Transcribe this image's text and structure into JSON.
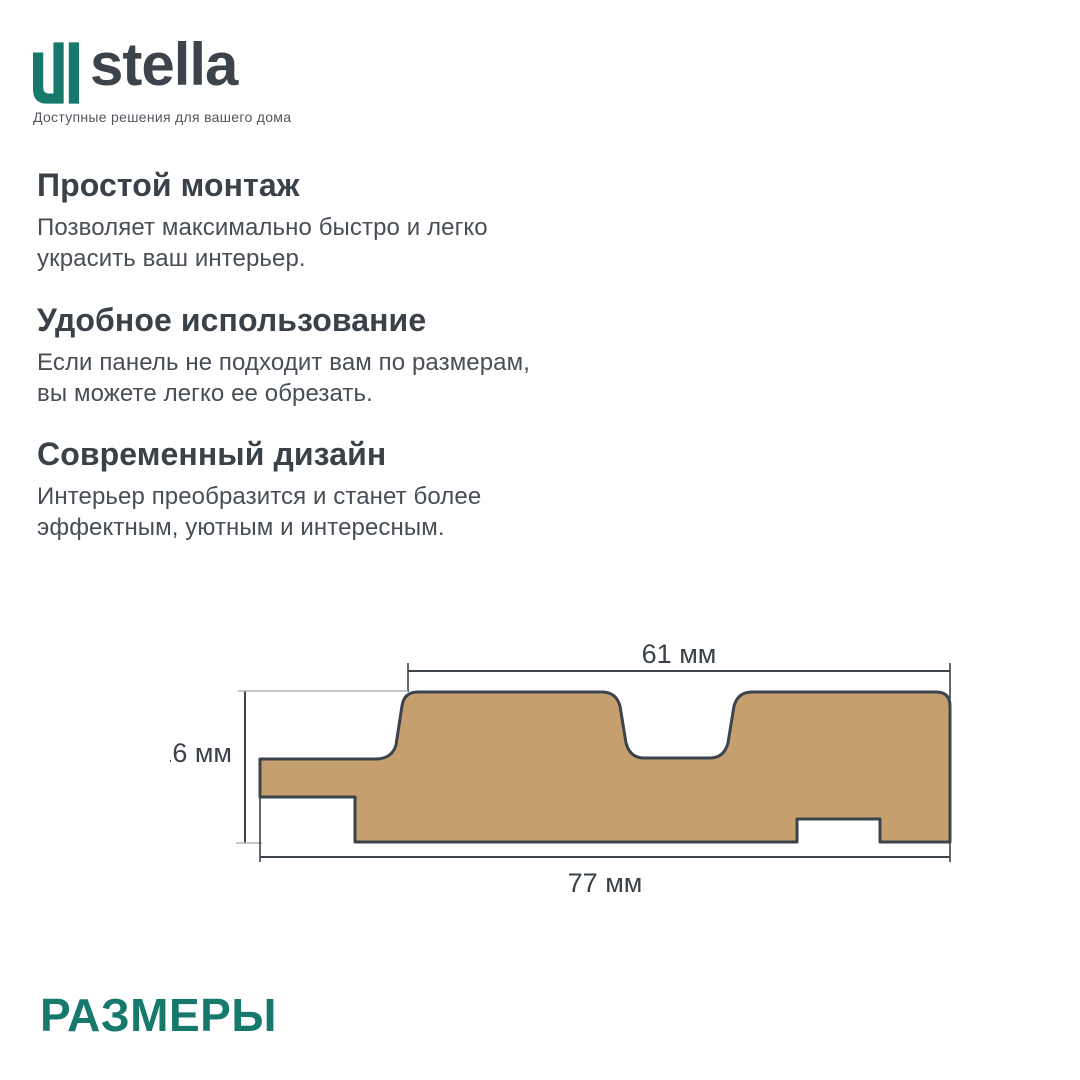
{
  "brand": {
    "name": "stella",
    "tagline": "Доступные решения для вашего дома",
    "accent_color": "#16796C",
    "wordmark_color": "#3C434B"
  },
  "sections": [
    {
      "heading": "Простой монтаж",
      "body": "Позволяет максимально быстро и легко\nукрасить ваш интерьер."
    },
    {
      "heading": "Удобное использование",
      "body": "Если панель не подходит вам по размерам,\nвы можете легко ее обрезать."
    },
    {
      "heading": "Современный дизайн",
      "body": "Интерьер преобразится и станет более\nэффектным, уютным и интересным."
    }
  ],
  "diagram": {
    "dim_top": "61 мм",
    "dim_left": "16 мм",
    "dim_bottom": "77 мм",
    "panel_fill": "#C5A06E",
    "outline_color": "#3C434D"
  },
  "footer": {
    "title": "РАЗМЕРЫ"
  }
}
